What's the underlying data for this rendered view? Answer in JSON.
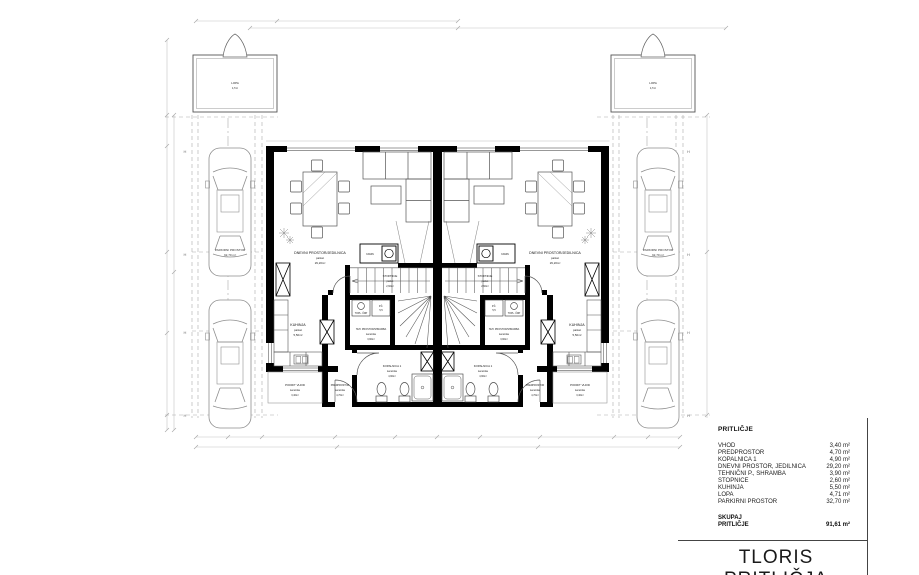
{
  "title": "TLORIS PRITLIČJA",
  "legend": {
    "heading": "PRITLIČJE",
    "items": [
      {
        "label": "VHOD",
        "value": "3,40 m²"
      },
      {
        "label": "PREDPROSTOR",
        "value": "4,70 m²"
      },
      {
        "label": "KOPALNICA 1",
        "value": "4,90 m²"
      },
      {
        "label": "DNEVNI PROSTOR, JEDILNICA",
        "value": "29,20 m²"
      },
      {
        "label": "TEHNIČNI P., SHRAMBA",
        "value": "3,90 m²"
      },
      {
        "label": "STOPNICE",
        "value": "2,60 m²"
      },
      {
        "label": "KUHINJA",
        "value": "5,50 m²"
      },
      {
        "label": "LOPA",
        "value": "4,71 m²"
      },
      {
        "label": "PARKIRNI PROSTOR",
        "value": "32,70 m²"
      }
    ],
    "total_label_1": "SKUPAJ",
    "total_label_2": "PRITLIČJE",
    "total_value": "91,61 m²"
  },
  "plan": {
    "rooms": {
      "living": {
        "name": "DNEVNI PROSTOR/JEDILNICA",
        "finish": "parket",
        "area": "29,20m²"
      },
      "kitchen": {
        "name": "KUHINJA",
        "finish": "parket",
        "area": "5,50m²"
      },
      "stairs": {
        "name": "STOPNICE",
        "finish": "parket",
        "area": "2,60m²"
      },
      "tech": {
        "name": "TEH. PROSTOR/SHRAMBA",
        "finish": "keramika",
        "area": "3,90m²"
      },
      "bath": {
        "name": "KOPALNICA 1",
        "finish": "keramika",
        "area": "4,90m²"
      },
      "hall": {
        "name": "PREDPROSTOR",
        "finish": "keramika",
        "area": "4,70m²"
      },
      "entry": {
        "name": "POKRIT VHOD",
        "finish": "keramika",
        "area": "3,40m²"
      }
    },
    "fireplace_label": "KAMIN",
    "heat_pump_label": "TOPL. ČRP",
    "pc_label_1": "P.Č.",
    "pc_label_2": "5,5",
    "shed": {
      "name": "LOPA",
      "area": "4,7m²"
    },
    "parking": {
      "name": "PARKIRNI PROSTOR",
      "area": "32,70 m²"
    },
    "section_marker": "H"
  },
  "colors": {
    "wall": "#000000",
    "furniture_line": "#666666",
    "dim_line": "#c4c4c4",
    "text": "#1a1a1a"
  }
}
